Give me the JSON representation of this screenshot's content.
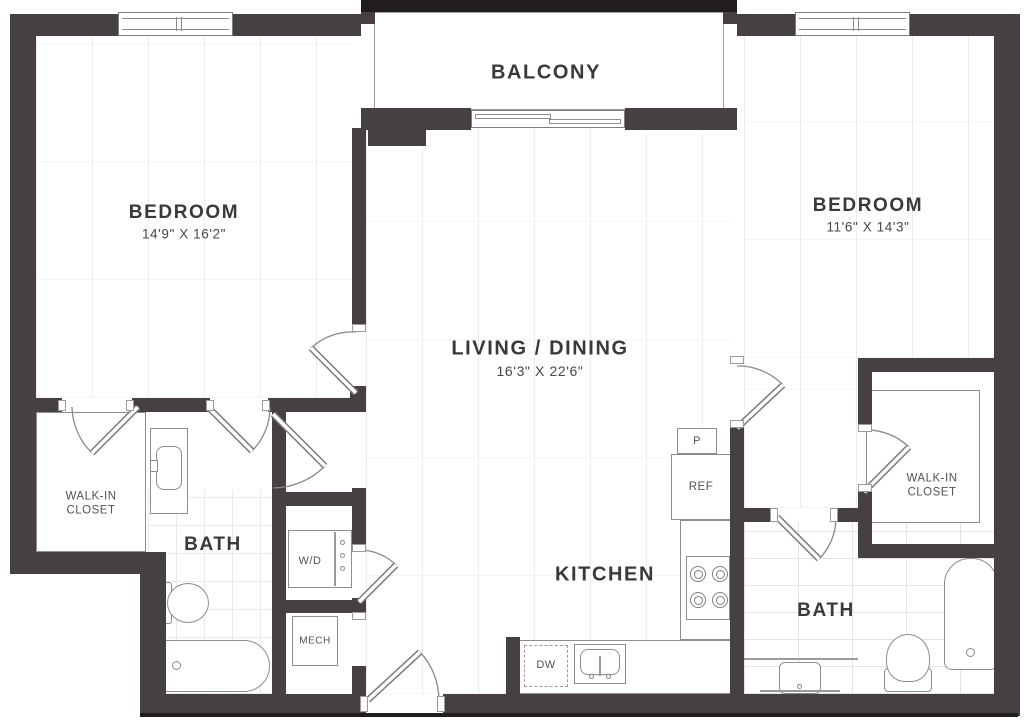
{
  "colors": {
    "wall": "#474040",
    "line": "#8d8d8d",
    "text": "#3c3837"
  },
  "rooms": {
    "balcony": {
      "label": "BALCONY"
    },
    "bedroom_left": {
      "label": "BEDROOM",
      "dims": "14'9\" X 16'2\""
    },
    "bedroom_right": {
      "label": "BEDROOM",
      "dims": "11'6\" X 14'3\""
    },
    "living_dining": {
      "label": "LIVING / DINING",
      "dims": "16'3\" X 22'6\""
    },
    "kitchen": {
      "label": "KITCHEN"
    },
    "bath_left": {
      "label": "BATH"
    },
    "bath_right": {
      "label": "BATH"
    },
    "closet_left": {
      "label": "WALK-IN CLOSET"
    },
    "closet_right": {
      "label": "WALK-IN CLOSET"
    },
    "laundry": {
      "label": "W/D"
    },
    "mech": {
      "label": "MECH"
    }
  },
  "appliances": {
    "pantry": "P",
    "refrigerator": "REF",
    "dishwasher": "DW"
  }
}
